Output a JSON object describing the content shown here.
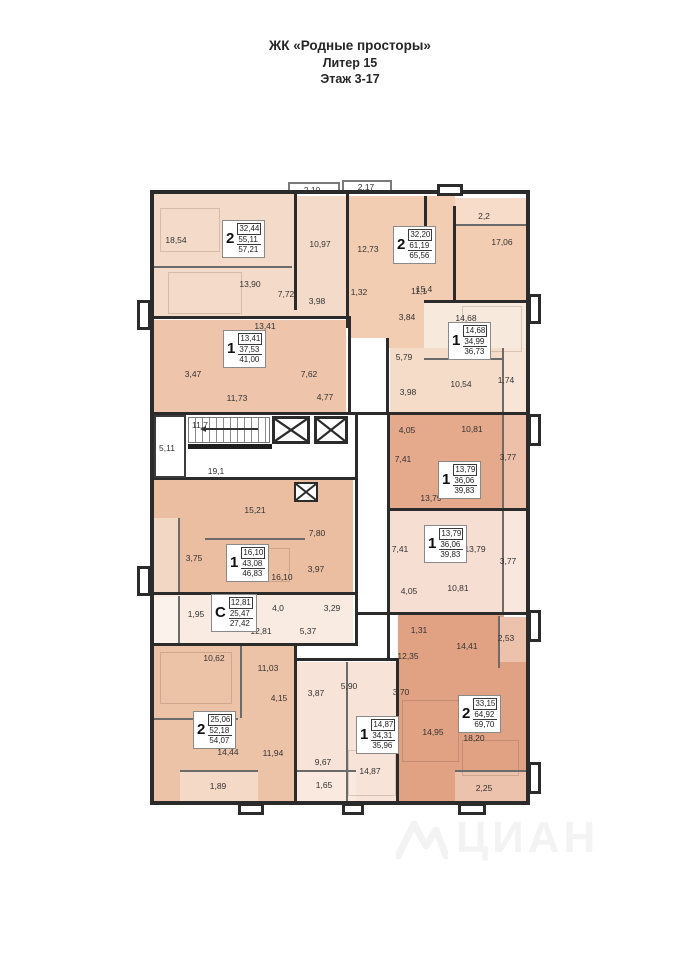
{
  "title": {
    "line1": "ЖК «Родные просторы»",
    "line2": "Литер 15",
    "line3": "Этаж 3-17"
  },
  "watermark": {
    "text": "ЦИАН"
  },
  "colors": {
    "wall": "#2b2b2b",
    "apt_top_left": "#f4dbc9",
    "apt_top_middle": "#f2cdb2",
    "apt_top_right": "#f5dcc9",
    "apt_mid_right_first": "#e5a98c",
    "apt_mid_right_second": "#f6ded3",
    "apt_bottom_right": "#e0a283",
    "apt_center_left_upper": "#eec5ab",
    "apt_center_left_lower": "#ebbda1",
    "apt_studio": "#f9ebe1",
    "apt_bottom_left": "#edc3a8",
    "apt_bottom_center": "#f7e3d7"
  },
  "plan": {
    "apartments": [
      {
        "type": "2",
        "living": "32,44",
        "total": "55,11",
        "full": "57,21",
        "x": 222,
        "y": 220
      },
      {
        "type": "2",
        "living": "32,20",
        "total": "61,19",
        "full": "65,56",
        "x": 393,
        "y": 226
      },
      {
        "type": "1",
        "living": "14,68",
        "total": "34,99",
        "full": "36,73",
        "x": 448,
        "y": 322
      },
      {
        "type": "1",
        "living": "13,41",
        "total": "37,53",
        "full": "41,00",
        "x": 223,
        "y": 330
      },
      {
        "type": "1",
        "living": "13,79",
        "total": "36,06",
        "full": "39,83",
        "x": 438,
        "y": 461
      },
      {
        "type": "1",
        "living": "13,79",
        "total": "36,06",
        "full": "39,83",
        "x": 424,
        "y": 525
      },
      {
        "type": "1",
        "living": "16,10",
        "total": "43,08",
        "full": "46,83",
        "x": 226,
        "y": 544
      },
      {
        "type": "С",
        "living": "12,81",
        "total": "25,47",
        "full": "27,42",
        "x": 211,
        "y": 594
      },
      {
        "type": "2",
        "living": "25,06",
        "total": "52,18",
        "full": "54,07",
        "x": 193,
        "y": 711
      },
      {
        "type": "1",
        "living": "14,87",
        "total": "34,31",
        "full": "35,96",
        "x": 356,
        "y": 716
      },
      {
        "type": "2",
        "living": "33,15",
        "total": "64,92",
        "full": "69,70",
        "x": 458,
        "y": 695
      }
    ],
    "room_labels": [
      {
        "t": "2,10",
        "x": 312,
        "y": 190
      },
      {
        "t": "2,17",
        "x": 366,
        "y": 187
      },
      {
        "t": "18,54",
        "x": 176,
        "y": 240
      },
      {
        "t": "10,97",
        "x": 320,
        "y": 244
      },
      {
        "t": "12,73",
        "x": 368,
        "y": 249
      },
      {
        "t": "2,2",
        "x": 484,
        "y": 216
      },
      {
        "t": "17,06",
        "x": 502,
        "y": 242
      },
      {
        "t": "15,4",
        "x": 424,
        "y": 289
      },
      {
        "t": "13,90",
        "x": 250,
        "y": 284
      },
      {
        "t": "7,72",
        "x": 286,
        "y": 294
      },
      {
        "t": "3,98",
        "x": 317,
        "y": 301
      },
      {
        "t": "1,32",
        "x": 359,
        "y": 292
      },
      {
        "t": "11,1",
        "x": 419,
        "y": 291
      },
      {
        "t": "13,41",
        "x": 265,
        "y": 326
      },
      {
        "t": "3,84",
        "x": 407,
        "y": 317
      },
      {
        "t": "14,68",
        "x": 466,
        "y": 318
      },
      {
        "t": "5,79",
        "x": 404,
        "y": 357
      },
      {
        "t": "10,54",
        "x": 461,
        "y": 384
      },
      {
        "t": "1,74",
        "x": 506,
        "y": 380
      },
      {
        "t": "3,47",
        "x": 193,
        "y": 374
      },
      {
        "t": "11,73",
        "x": 237,
        "y": 398
      },
      {
        "t": "7,62",
        "x": 309,
        "y": 374
      },
      {
        "t": "4,77",
        "x": 325,
        "y": 397
      },
      {
        "t": "11,7",
        "x": 200,
        "y": 425
      },
      {
        "t": "5,11",
        "x": 167,
        "y": 448
      },
      {
        "t": "19,1",
        "x": 216,
        "y": 471
      },
      {
        "t": "3,98",
        "x": 408,
        "y": 392
      },
      {
        "t": "4,05",
        "x": 407,
        "y": 430
      },
      {
        "t": "10,81",
        "x": 472,
        "y": 429
      },
      {
        "t": "7,41",
        "x": 403,
        "y": 459
      },
      {
        "t": "3,77",
        "x": 508,
        "y": 457
      },
      {
        "t": "13,79",
        "x": 431,
        "y": 498
      },
      {
        "t": "7,41",
        "x": 400,
        "y": 549
      },
      {
        "t": "13,79",
        "x": 475,
        "y": 549
      },
      {
        "t": "3,77",
        "x": 508,
        "y": 561
      },
      {
        "t": "10,81",
        "x": 458,
        "y": 588
      },
      {
        "t": "4,05",
        "x": 409,
        "y": 591
      },
      {
        "t": "15,21",
        "x": 255,
        "y": 510
      },
      {
        "t": "7,80",
        "x": 317,
        "y": 533
      },
      {
        "t": "3,75",
        "x": 194,
        "y": 558
      },
      {
        "t": "16,10",
        "x": 282,
        "y": 577
      },
      {
        "t": "3,97",
        "x": 316,
        "y": 569
      },
      {
        "t": "1,95",
        "x": 196,
        "y": 614
      },
      {
        "t": "4,0",
        "x": 278,
        "y": 608
      },
      {
        "t": "3,29",
        "x": 332,
        "y": 608
      },
      {
        "t": "12,81",
        "x": 261,
        "y": 631
      },
      {
        "t": "5,37",
        "x": 308,
        "y": 631
      },
      {
        "t": "1,31",
        "x": 419,
        "y": 630
      },
      {
        "t": "12,35",
        "x": 408,
        "y": 656
      },
      {
        "t": "2,53",
        "x": 506,
        "y": 638
      },
      {
        "t": "14,41",
        "x": 467,
        "y": 646
      },
      {
        "t": "10,62",
        "x": 214,
        "y": 658
      },
      {
        "t": "11,03",
        "x": 268,
        "y": 668
      },
      {
        "t": "4,15",
        "x": 279,
        "y": 698
      },
      {
        "t": "3,87",
        "x": 316,
        "y": 693
      },
      {
        "t": "5,90",
        "x": 349,
        "y": 686
      },
      {
        "t": "3,70",
        "x": 401,
        "y": 692
      },
      {
        "t": "14,44",
        "x": 228,
        "y": 752
      },
      {
        "t": "11,94",
        "x": 273,
        "y": 753
      },
      {
        "t": "9,67",
        "x": 323,
        "y": 762
      },
      {
        "t": "14,95",
        "x": 433,
        "y": 732
      },
      {
        "t": "18,20",
        "x": 474,
        "y": 738
      },
      {
        "t": "14,87",
        "x": 370,
        "y": 771
      },
      {
        "t": "1,89",
        "x": 218,
        "y": 786
      },
      {
        "t": "1,65",
        "x": 324,
        "y": 785
      },
      {
        "t": "2,25",
        "x": 484,
        "y": 788
      }
    ]
  }
}
